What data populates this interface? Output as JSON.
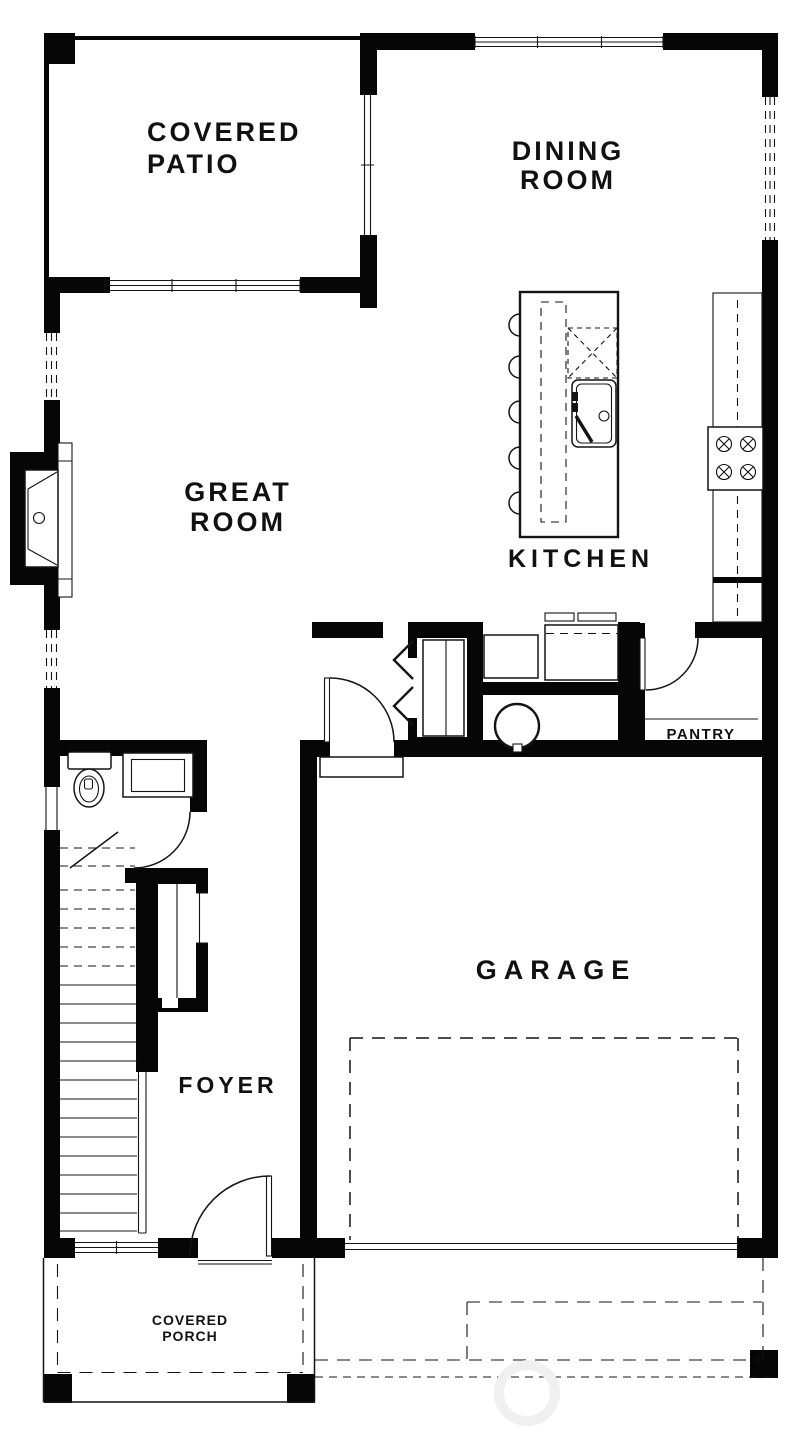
{
  "document": {
    "type": "architectural-floor-plan",
    "style": "black-and-white line drawing"
  },
  "colors": {
    "walls": "#060606",
    "background": "#ffffff",
    "linework": "#141414",
    "watermark": "#f0f0f0"
  },
  "rooms": {
    "covered_patio": {
      "lines": [
        "COVERED",
        "PATIO"
      ]
    },
    "dining_room": {
      "lines": [
        "DINING",
        "ROOM"
      ]
    },
    "great_room": {
      "lines": [
        "GREAT",
        "ROOM"
      ]
    },
    "kitchen": {
      "lines": [
        "KITCHEN"
      ]
    },
    "pantry": {
      "lines": [
        "PANTRY"
      ]
    },
    "garage": {
      "lines": [
        "GARAGE"
      ]
    },
    "foyer": {
      "lines": [
        "FOYER"
      ]
    },
    "covered_porch": {
      "lines": [
        "COVERED",
        "PORCH"
      ]
    }
  },
  "fixtures": [
    "fireplace",
    "kitchen-island",
    "bar-stools",
    "dishwasher",
    "kitchen-sink",
    "range-cooktop",
    "kitchen-counter",
    "refrigerator-space",
    "pantry-shelf",
    "washer",
    "dryer",
    "water-heater",
    "toilet",
    "vanity-sink",
    "staircase",
    "coat-closet",
    "mudroom-closet-bifold-doors",
    "front-door",
    "garage-entry-door",
    "powder-room-door",
    "pantry-door",
    "garage-overhead-door",
    "patio-slider-door",
    "windows",
    "porch-posts",
    "garage-ceiling-dashed-line",
    "driveway-dashed-line"
  ]
}
